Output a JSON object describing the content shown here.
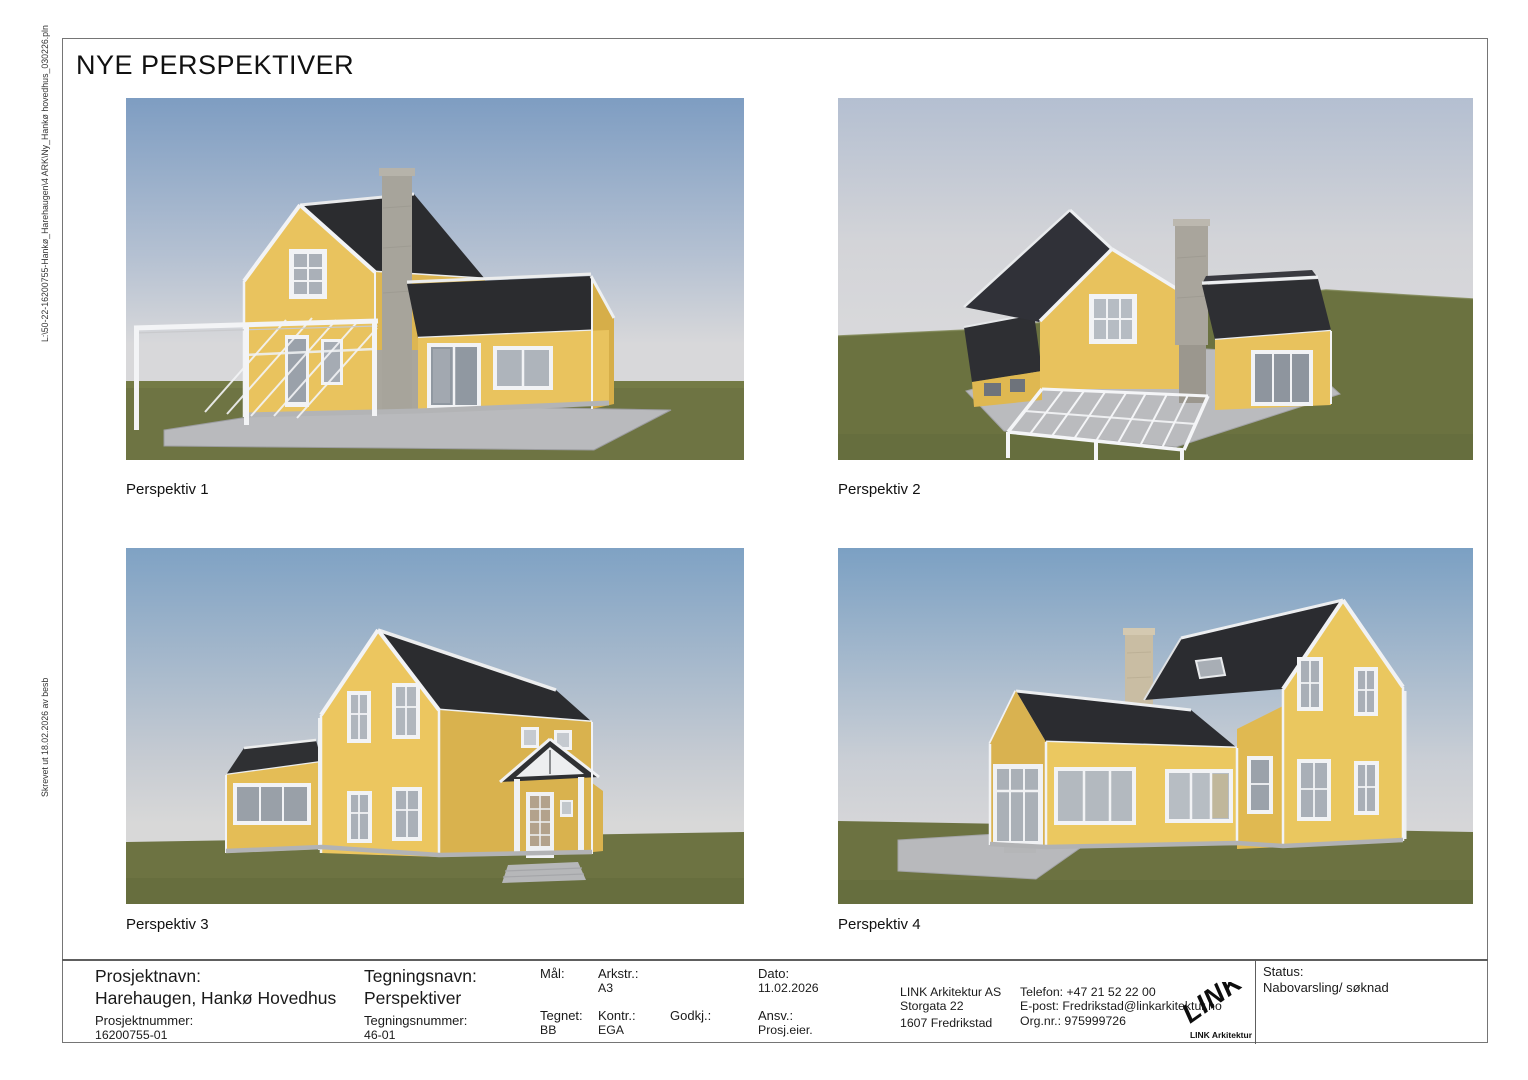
{
  "sheet": {
    "title": "NYE PERSPEKTIVER",
    "margin_notes": {
      "file_path": "L:\\50-22-16200755-Hankø_Harehaugen\\4 ARK\\Ny_Hankø hovedhus_030226.pln",
      "printed_info": "Skrevet ut 18.02.2026 av besb"
    }
  },
  "perspectives": [
    {
      "label": "Perspektiv 1"
    },
    {
      "label": "Perspektiv 2"
    },
    {
      "label": "Perspektiv 3"
    },
    {
      "label": "Perspektiv 4"
    }
  ],
  "title_block": {
    "project_name": {
      "label": "Prosjektnavn:",
      "value": "Harehaugen, Hankø Hovedhus"
    },
    "project_number": {
      "label": "Prosjektnummer:",
      "value": "16200755-01"
    },
    "drawing_name": {
      "label": "Tegningsnavn:",
      "value": "Perspektiver"
    },
    "drawing_number": {
      "label": "Tegningsnummer:",
      "value": "46-01"
    },
    "scale": {
      "label": "Mål:",
      "value": ""
    },
    "sheet_format": {
      "label": "Arkstr.:",
      "value": "A3"
    },
    "date": {
      "label": "Dato:",
      "value": "11.02.2026"
    },
    "drawn_by": {
      "label": "Tegnet:",
      "value": "BB"
    },
    "checked_by": {
      "label": "Kontr.:",
      "value": "EGA"
    },
    "approved_by": {
      "label": "Godkj.:",
      "value": ""
    },
    "responsible": {
      "label": "Ansv.:",
      "value": "Prosj.eier."
    },
    "status": {
      "label": "Status:",
      "value": "Nabovarsling/ søknad"
    }
  },
  "company": {
    "name": "LINK Arkitektur AS",
    "address": "Storgata 22",
    "postal_city": "1607 Fredrikstad",
    "phone": "Telefon: +47 21 52 22 00",
    "email": "E-post: Fredrikstad@linkarkitektur.no",
    "org_number": "Org.nr.: 975999726",
    "logo_text": "LINK",
    "logo_caption": "LINK Arkitektur"
  },
  "colors": {
    "wall_yellow": "#e9c35e",
    "wall_yellow_shaded": "#d9b24e",
    "roof_dark": "#2b2c2f",
    "trim_white": "#f2f3f5",
    "sky_blue": "#7e9dc2",
    "sky_horizon": "#d8d8da",
    "grass_green": "#6d7342",
    "terrace_grey": "#b9babd",
    "chimney_grey": "#a7a49b",
    "chimney_tan": "#c9bda3"
  }
}
